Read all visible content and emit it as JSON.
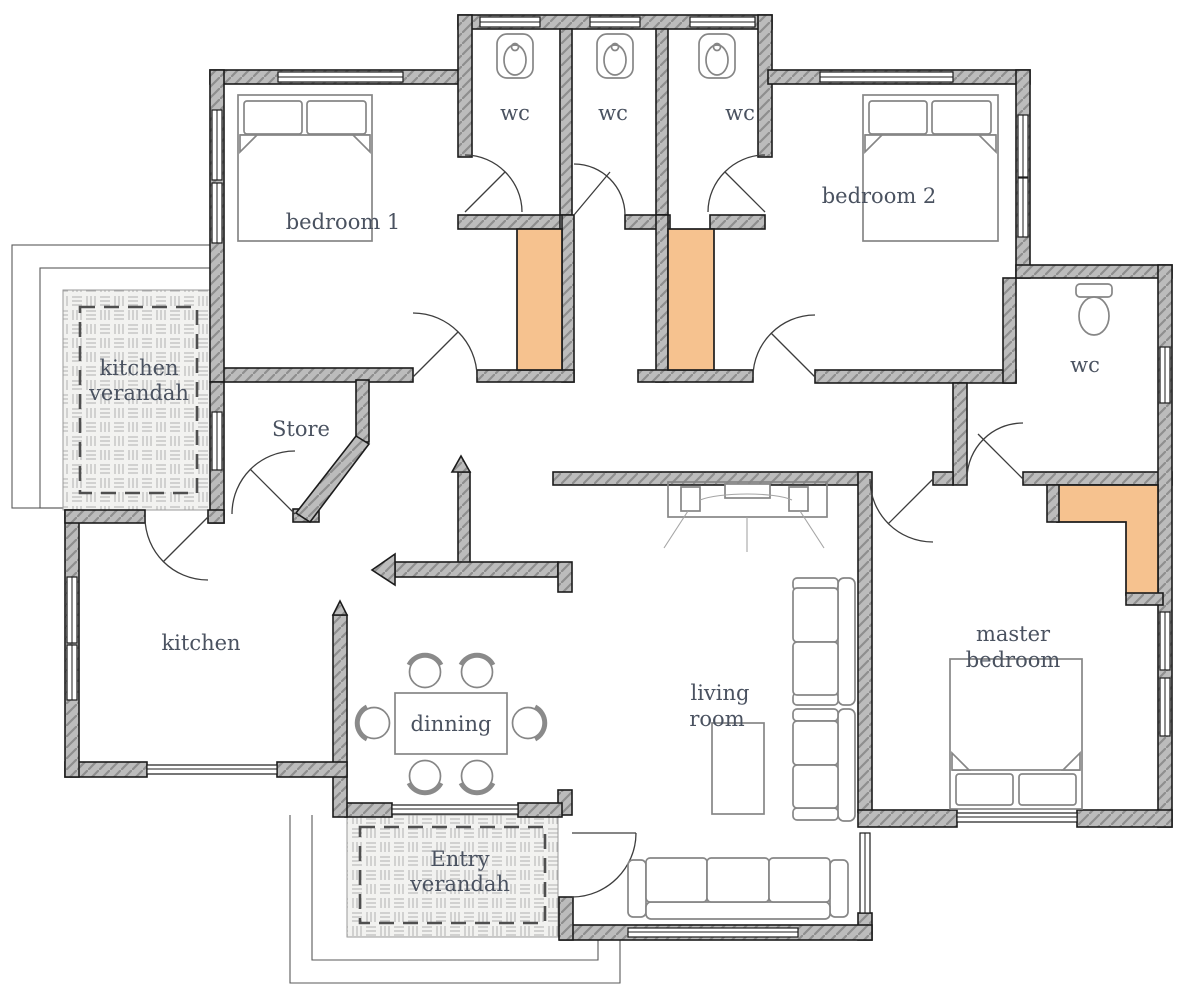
{
  "title": "House floor plan",
  "colors": {
    "wall_gray": "#bcbcbc",
    "wall_hatch_line": "#8e8e8e",
    "outline_black": "#1c1c1c",
    "closet_orange": "#f6c28f",
    "label_text": "#4a5260",
    "verandah_fill": "#f2f2f0"
  },
  "rooms": {
    "bedroom1": {
      "label": "bedroom 1"
    },
    "bedroom2": {
      "label": "bedroom 2"
    },
    "wc_top_1": {
      "label": "wc"
    },
    "wc_top_2": {
      "label": "wc"
    },
    "wc_top_3": {
      "label": "wc"
    },
    "wc_right": {
      "label": "wc"
    },
    "kitchen_verandah": {
      "label_line1": "kitchen",
      "label_line2": "verandah"
    },
    "store": {
      "label": "Store"
    },
    "kitchen": {
      "label": "kitchen"
    },
    "dining": {
      "label": "dinning"
    },
    "living_room": {
      "label_line1": "living",
      "label_line2": "room"
    },
    "master_bedroom": {
      "label_line1": "master",
      "label_line2": "bedroom"
    },
    "entry_verandah": {
      "label_line1": "Entry",
      "label_line2": "verandah"
    }
  }
}
